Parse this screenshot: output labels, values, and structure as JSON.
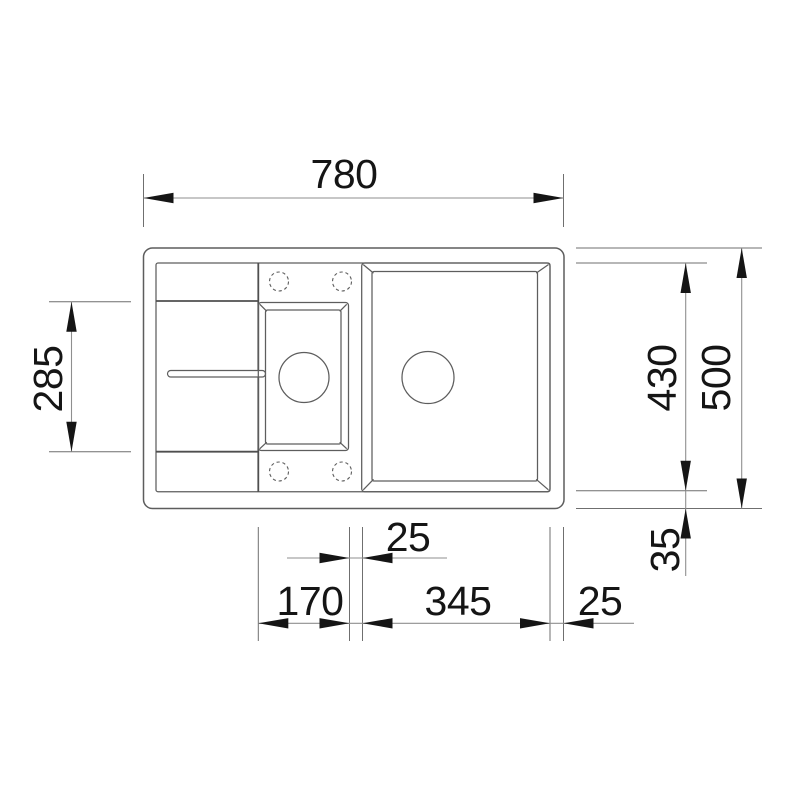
{
  "drawing": {
    "type": "technical-dimension-drawing",
    "subject": "kitchen sink top view, one and a half bowls with drainer",
    "colors": {
      "background": "#ffffff",
      "sink_outline": "#5d5d5d",
      "dimension_line": "#8f8f8f",
      "extension_line": "#6f6f6f",
      "arrow_and_text": "#151515"
    },
    "labels": {
      "top_width": "780",
      "drainer_depth": "285",
      "bowl_depth": "430",
      "overall_depth": "500",
      "bottom_rim": "35",
      "bowl_gap": "25",
      "small_bowl_width": "170",
      "main_bowl_width": "345",
      "right_rim": "25"
    }
  }
}
